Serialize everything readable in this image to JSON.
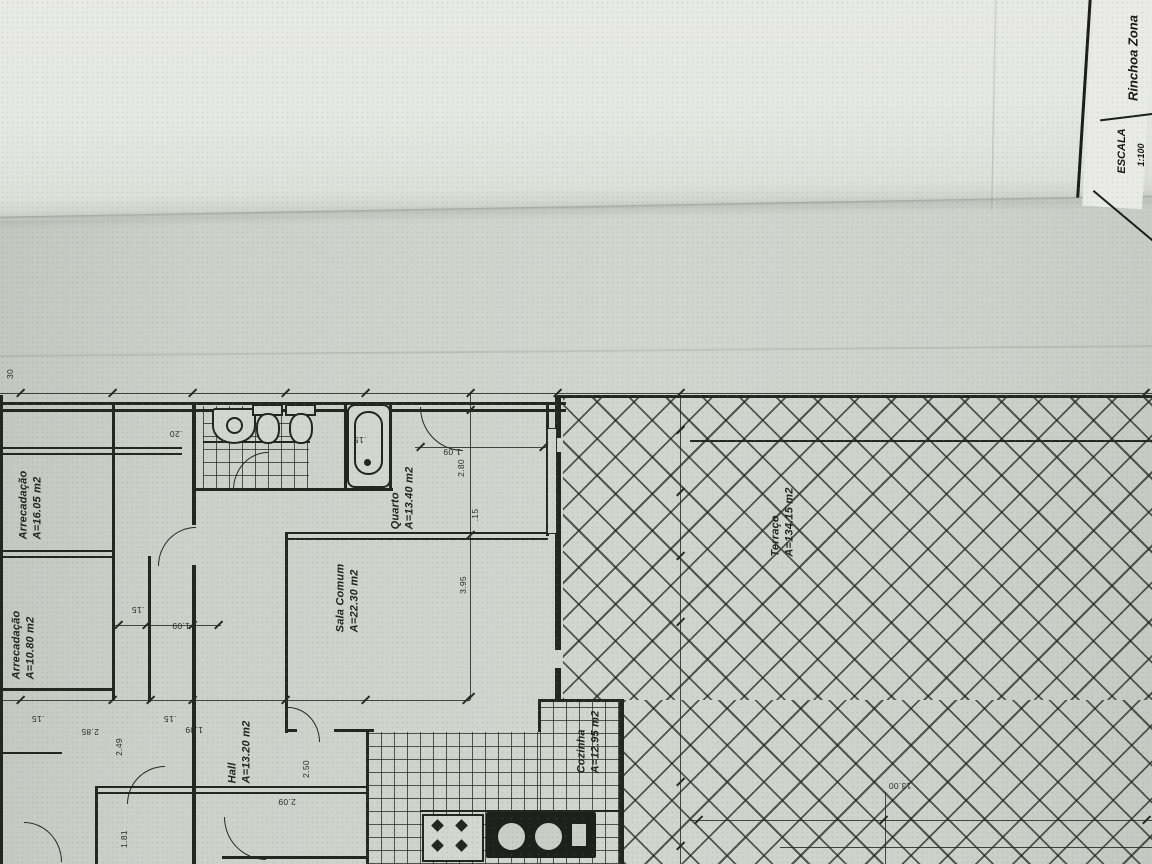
{
  "title_block": {
    "zone": "Rinchoa Zona",
    "scale_label": "ESCALA",
    "scale_value": "1:100"
  },
  "rooms": {
    "arrecadacao1": {
      "name": "Arrecadação",
      "area": "A=16.05 m2"
    },
    "arrecadacao2": {
      "name": "Arrecadação",
      "area": "A=10.80 m2"
    },
    "quarto": {
      "name": "Quarto",
      "area": "A=13.40 m2"
    },
    "sala_comum": {
      "name": "Sala Comum",
      "area": "A=22.30 m2"
    },
    "hall": {
      "name": "Hall",
      "area": "A=13.20 m2"
    },
    "cozinha": {
      "name": "Cozinha",
      "area": "A=12.95 m2"
    },
    "terraco": {
      "name": "Terraço",
      "area": "A=134.15 m2"
    }
  },
  "dims": {
    "t30": "30",
    "d20": ".20",
    "d15_tub": ".15",
    "d109_q": "1.09",
    "d280": "2.80",
    "d15_mid": ".15",
    "d395": "3.95",
    "d15_c": ".15",
    "d109_c": "1.09",
    "d15_d": ".15",
    "d285": "2.85",
    "d15_e": ".15",
    "d109_d": "1.09",
    "d249": "2.49",
    "d250": "2.50",
    "d209": "2.09",
    "d181": "1.81",
    "d1300": "13.00"
  },
  "colors": {
    "paper": "#ccd1ca",
    "paper_light": "#e7e8e4",
    "ink": "#23261f"
  }
}
